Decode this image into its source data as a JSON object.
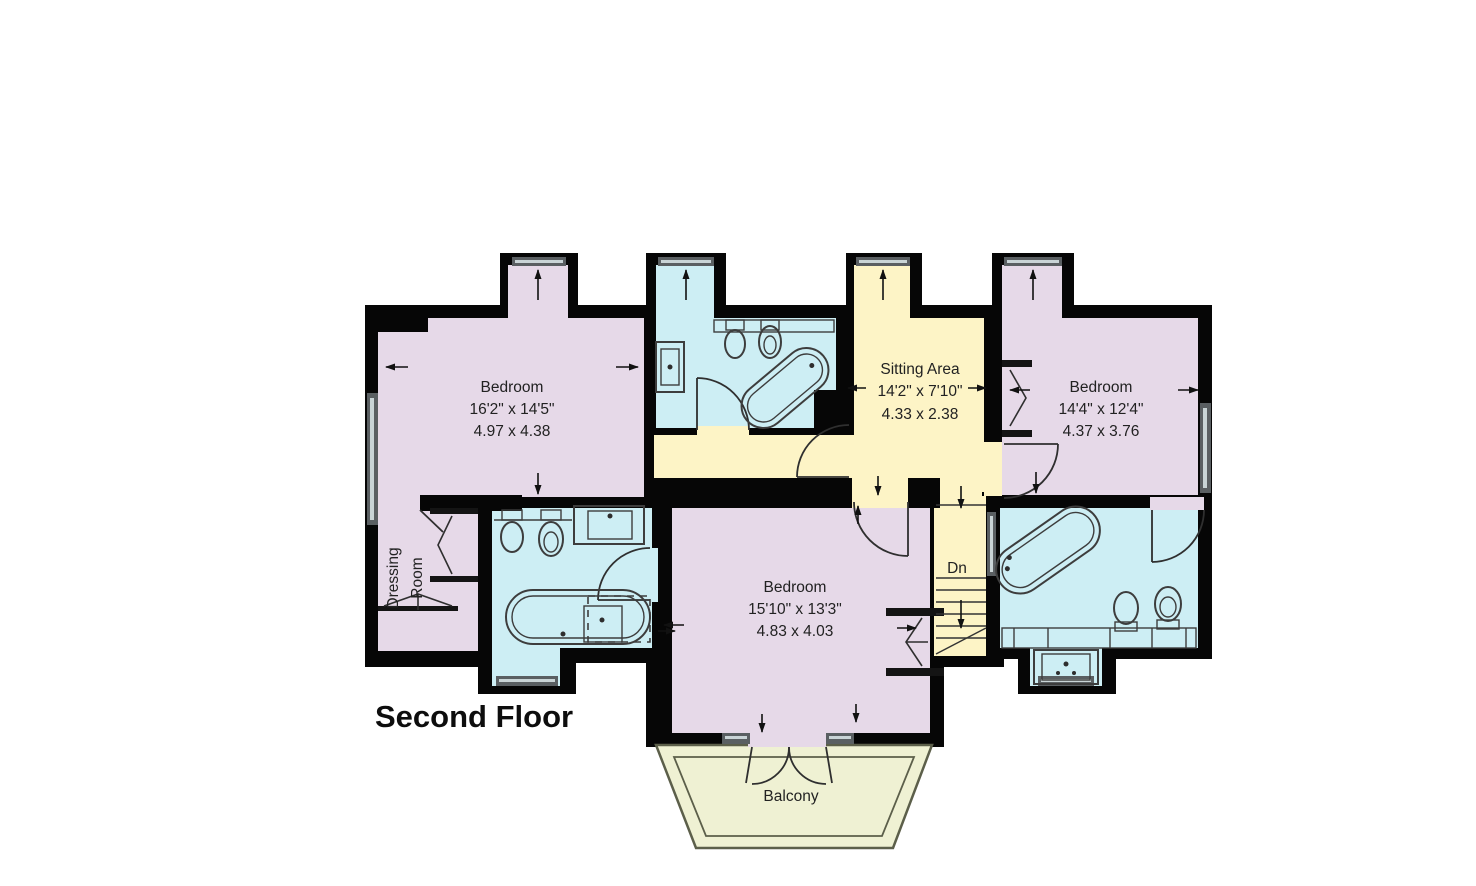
{
  "title": "Second Floor",
  "rooms": {
    "bedroom_top_left": {
      "name": "Bedroom",
      "imperial": "16'2\" x 14'5\"",
      "metric": "4.97 x 4.38"
    },
    "sitting_area": {
      "name": "Sitting Area",
      "imperial": "14'2\" x 7'10\"",
      "metric": "4.33 x 2.38"
    },
    "bedroom_top_right": {
      "name": "Bedroom",
      "imperial": "14'4\" x 12'4\"",
      "metric": "4.37 x 3.76"
    },
    "bedroom_center": {
      "name": "Bedroom",
      "imperial": "15'10\" x 13'3\"",
      "metric": "4.83 x 4.03"
    },
    "dressing_room": {
      "line1": "Dressing",
      "line2": "Room"
    },
    "stairs": {
      "label": "Dn"
    },
    "balcony": {
      "name": "Balcony"
    }
  },
  "colors": {
    "bedroom": "#e6d9e8",
    "bath": "#cdeef4",
    "hall": "#fdf4c6",
    "balcony": "#eff1d3",
    "wall": "#060606"
  }
}
